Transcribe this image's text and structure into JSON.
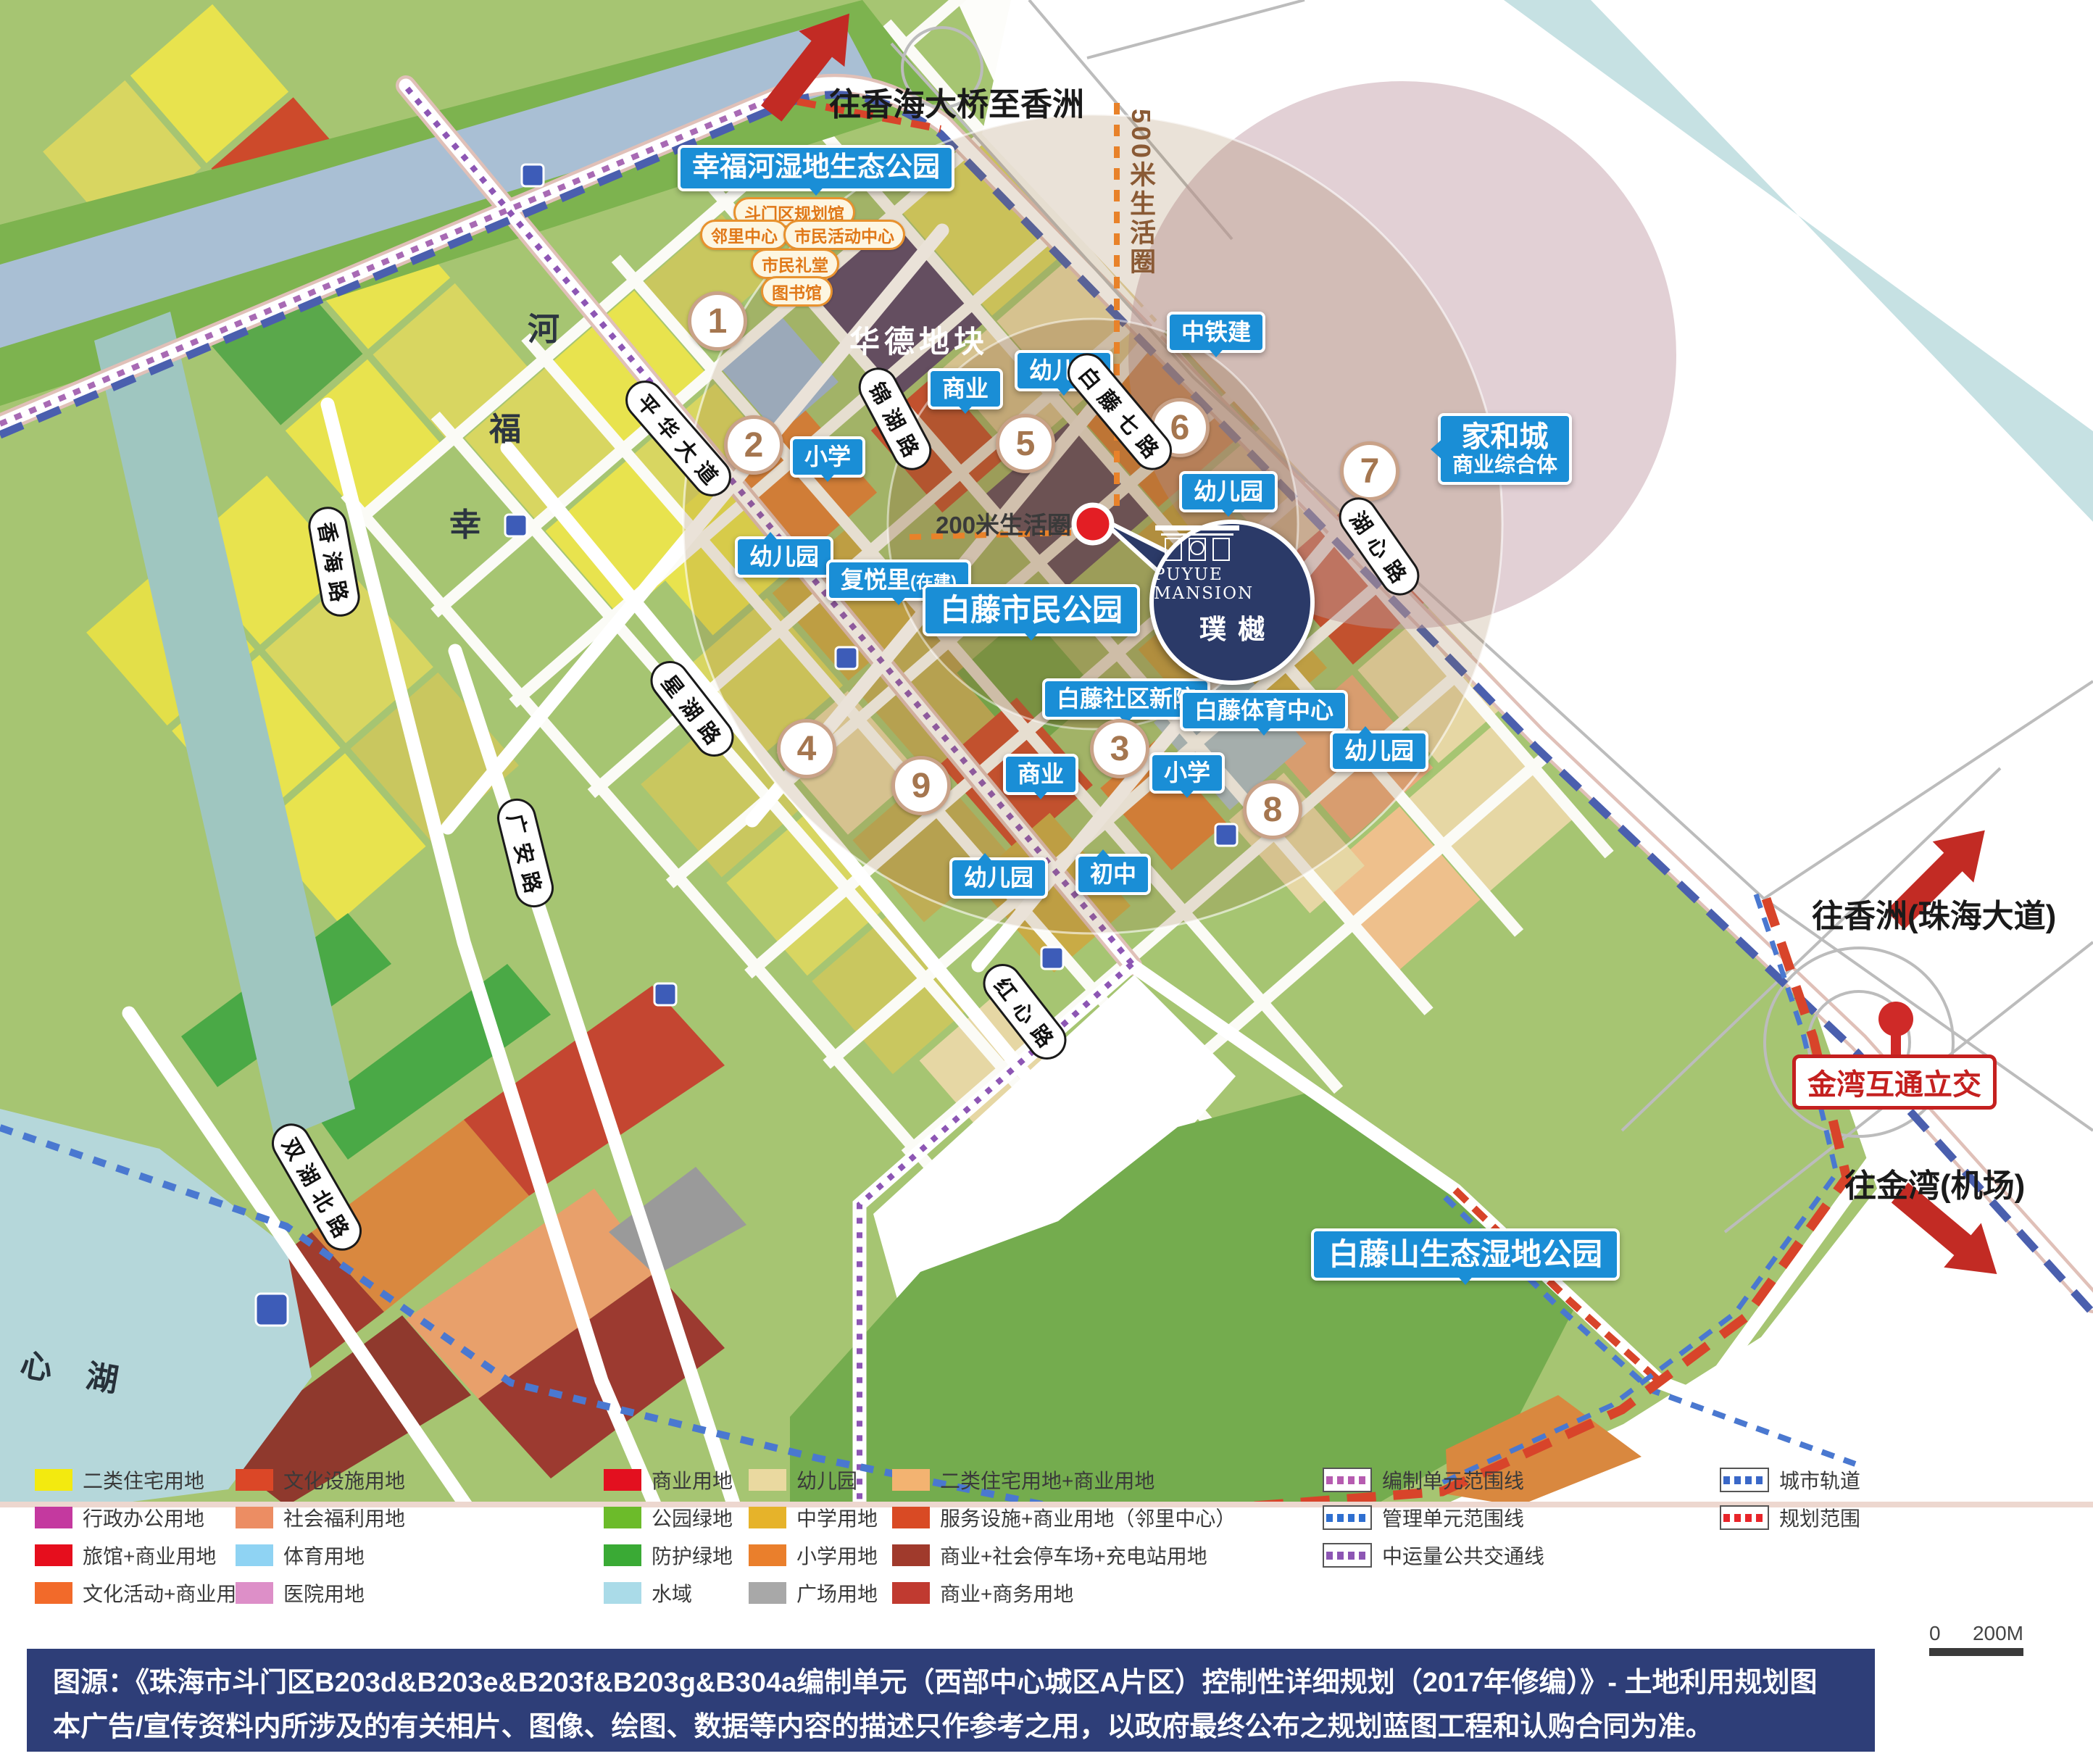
{
  "theme": {
    "label_blue": "#1a8ed6",
    "navy": "#2b3a68",
    "arrow_red": "#c4201f",
    "boundary_red": "#d8442a",
    "disclaimer_bg": "#2e3e78"
  },
  "map": {
    "direction_labels": [
      "往香海大桥至香洲",
      "往香洲(珠海大道)",
      "往金湾(机场)"
    ],
    "blue_labels": [
      {
        "text": "幸福河湿地生态公园"
      },
      {
        "text": "中铁建"
      },
      {
        "text": "家和城",
        "sub": "商业综合体"
      },
      {
        "text": "幼儿园"
      },
      {
        "text": "商业"
      },
      {
        "text": "小学"
      },
      {
        "text": "幼儿园"
      },
      {
        "text": "幼儿园"
      },
      {
        "text": "复悦里",
        "suffix": "(在建)"
      },
      {
        "text": "白藤市民公园"
      },
      {
        "text": "白藤社区新院"
      },
      {
        "text": "白藤体育中心"
      },
      {
        "text": "幼儿园"
      },
      {
        "text": "商业"
      },
      {
        "text": "小学"
      },
      {
        "text": "幼儿园"
      },
      {
        "text": "初中"
      },
      {
        "text": "白藤山生态湿地公园"
      }
    ],
    "orange_labels": [
      "斗门区规划馆",
      "邻里中心",
      "市民活动中心",
      "市民礼堂",
      "图书馆"
    ],
    "numbered_markers": [
      "1",
      "2",
      "3",
      "4",
      "5",
      "6",
      "7",
      "8",
      "9"
    ],
    "road_labels": [
      "平华大道",
      "香海路",
      "星湖路",
      "广安路",
      "双湖北路",
      "红心路",
      "锦湖路",
      "白藤七路",
      "湖心路"
    ],
    "river_chars": [
      "幸",
      "福",
      "河"
    ],
    "lake_label": "心湖",
    "area_labels": {
      "huade": "华德地块",
      "jinwan": "金湾互通立交"
    },
    "life_circles": {
      "c200": "200米生活圈",
      "c500": "500米生活圈"
    },
    "project": {
      "name_en": "PUYUE MANSION",
      "name_cn": "璞樾"
    }
  },
  "legend": {
    "columns": [
      {
        "items": [
          {
            "label": "二类住宅用地",
            "color": "#f3ea0f",
            "type": "fill"
          },
          {
            "label": "行政办公用地",
            "color": "#c4399f",
            "type": "fill"
          },
          {
            "label": "旅馆+商业用地",
            "color": "#e60e1d",
            "type": "fill"
          },
          {
            "label": "文化活动+商业用地",
            "color": "#f26a2a",
            "type": "fill"
          }
        ]
      },
      {
        "items": [
          {
            "label": "文化设施用地",
            "color": "#db4727",
            "type": "fill"
          },
          {
            "label": "社会福利用地",
            "color": "#ec8d63",
            "type": "fill"
          },
          {
            "label": "体育用地",
            "color": "#8fd3f3",
            "type": "fill"
          },
          {
            "label": "医院用地",
            "color": "#dd8fc8",
            "type": "fill"
          }
        ]
      },
      {
        "items": [
          {
            "label": "商业用地",
            "color": "#e3101f",
            "type": "fill"
          },
          {
            "label": "公园绿地",
            "color": "#6cbb2a",
            "type": "fill"
          },
          {
            "label": "防护绿地",
            "color": "#3aaa35",
            "type": "fill"
          },
          {
            "label": "水域",
            "color": "#aadbe8",
            "type": "fill"
          }
        ]
      },
      {
        "items": [
          {
            "label": "幼儿园",
            "color": "#ead9a0",
            "type": "fill"
          },
          {
            "label": "中学用地",
            "color": "#e6b32a",
            "type": "fill"
          },
          {
            "label": "小学用地",
            "color": "#ea7f2c",
            "type": "fill"
          },
          {
            "label": "广场用地",
            "color": "#a8a8a8",
            "type": "fill"
          }
        ]
      },
      {
        "items": [
          {
            "label": "二类住宅用地+商业用地",
            "color": "#f3b371",
            "type": "fill"
          },
          {
            "label": "服务设施+商业用地（邻里中心）",
            "color": "#d94a24",
            "type": "fill"
          },
          {
            "label": "商业+社会停车场+充电站用地",
            "color": "#a03a2c",
            "type": "fill"
          },
          {
            "label": "商业+商务用地",
            "color": "#c03a30",
            "type": "fill"
          }
        ]
      },
      {
        "items": [
          {
            "label": "编制单元范围线",
            "color": "#b65cb0",
            "type": "line"
          },
          {
            "label": "管理单元范围线",
            "color": "#2f6fd0",
            "type": "line"
          },
          {
            "label": "中运量公共交通线",
            "color": "#8d56b4",
            "type": "line"
          }
        ]
      },
      {
        "items": [
          {
            "label": "城市轨道",
            "color": "#3a68c8",
            "type": "line"
          },
          {
            "label": "规划范围",
            "color": "#e8252a",
            "type": "line"
          }
        ]
      }
    ]
  },
  "scale_bar": {
    "zero": "0",
    "max": "200M"
  },
  "disclaimer": {
    "line1": "图源：《珠海市斗门区B203d&B203e&B203f&B203g&B304a编制单元（西部中心城区A片区）控制性详细规划（2017年修编）》- 土地利用规划图",
    "line2": "本广告/宣传资料内所涉及的有关相片、图像、绘图、数据等内容的描述只作参考之用，以政府最终公布之规划蓝图工程和认购合同为准。"
  }
}
